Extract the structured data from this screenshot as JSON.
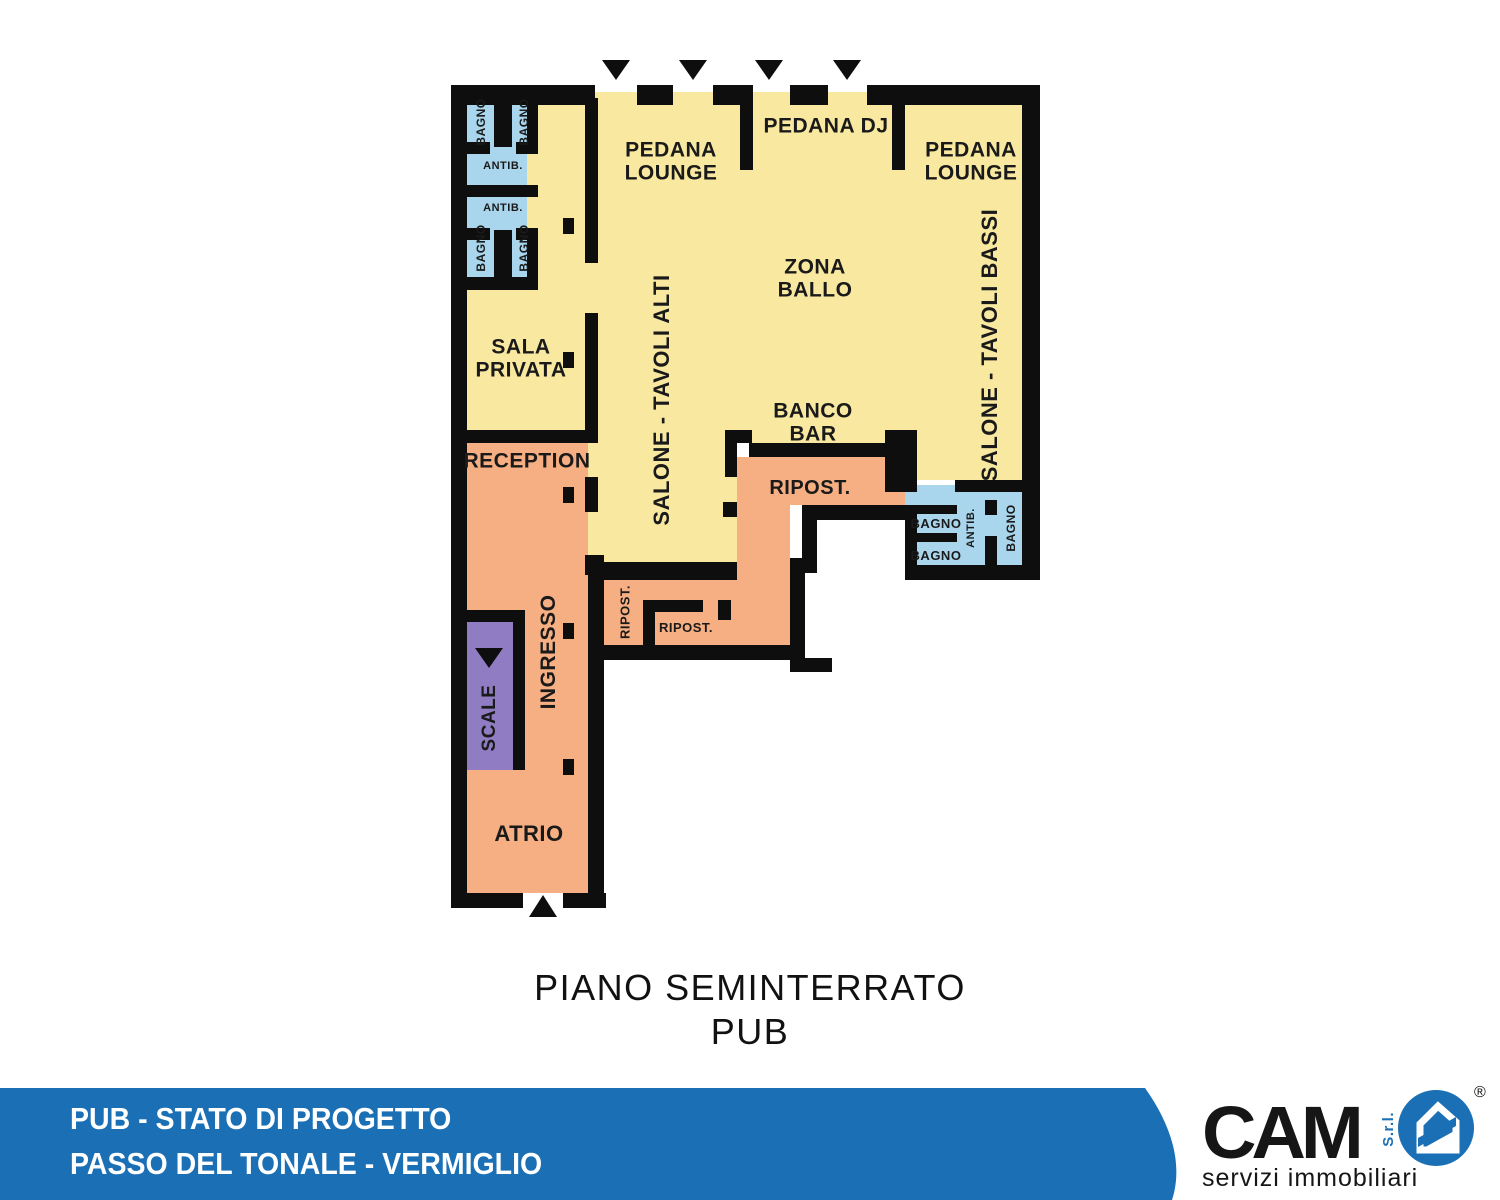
{
  "colors": {
    "wall": "#0e0e0e",
    "room_yellow": "#F8E8A0",
    "room_orange": "#F5AF82",
    "room_blue": "#A9D6EC",
    "room_purple": "#8F7CC2",
    "footer_blue": "#1A6FB5"
  },
  "plan": {
    "labels": {
      "pedana_lounge": "PEDANA LOUNGE",
      "pedana_dj": "PEDANA DJ",
      "zona_ballo": "ZONA BALLO",
      "sala_privata": "SALA PRIVATA",
      "reception": "RECEPTION",
      "salone_tavoli_alti": "SALONE - TAVOLI ALTI",
      "salone_tavoli_bassi": "SALONE - TAVOLI BASSI",
      "banco_bar": "BANCO BAR",
      "ripost": "RIPOST.",
      "ingresso": "INGRESSO",
      "scale": "SCALE",
      "atrio": "ATRIO",
      "bagno": "BAGNO",
      "antib": "ANTIB."
    }
  },
  "title": {
    "line1": "PIANO SEMINTERRATO",
    "line2": "PUB"
  },
  "footer": {
    "line1": "PUB - STATO DI PROGETTO",
    "line2": "PASSO DEL TONALE - VERMIGLIO"
  },
  "logo": {
    "brand": "CAM",
    "srl": "S.r.l.",
    "registered": "®",
    "tagline": "servizi immobiliari"
  }
}
